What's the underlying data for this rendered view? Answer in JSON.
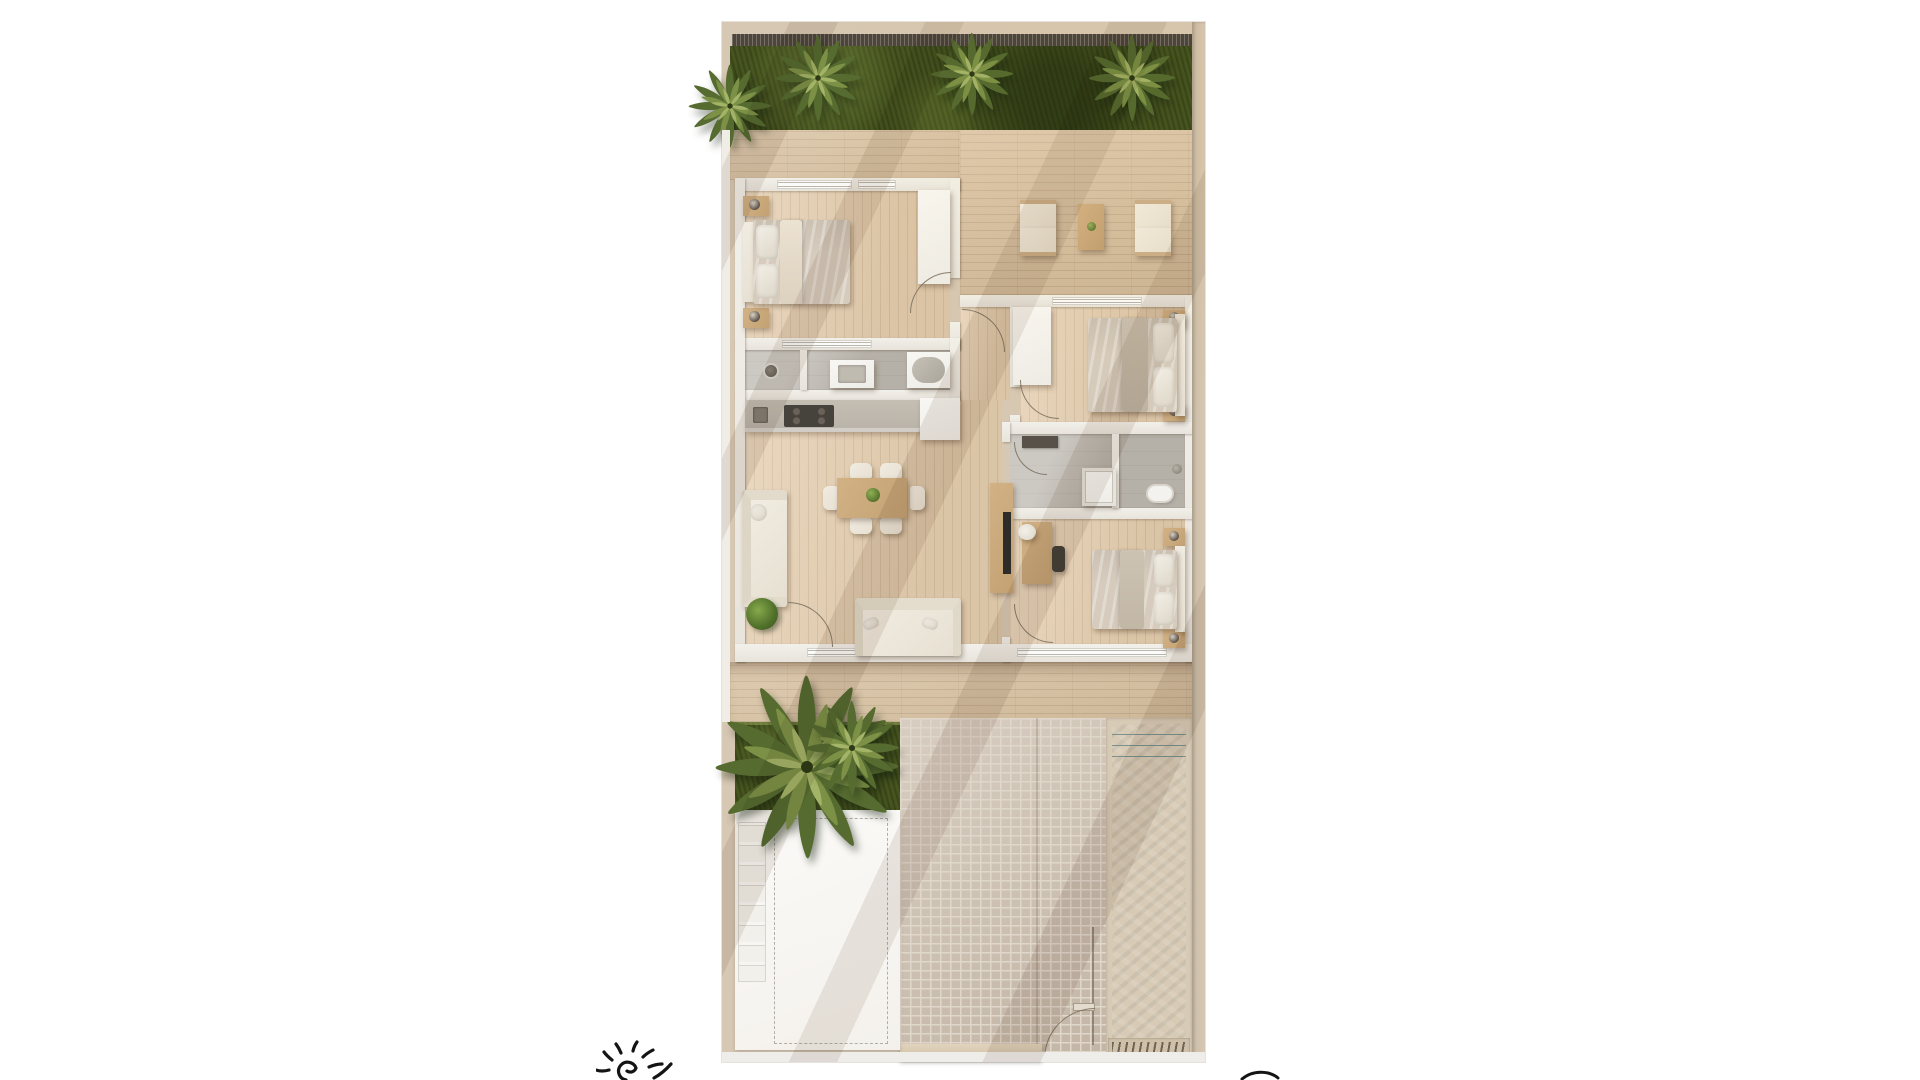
{
  "scene": {
    "type": "rendered-floor-plan",
    "view": "top-down",
    "description": "Photoreal top-down floor plan of a 3-bedroom villa with rear palm garden, wrap deck, pool, brick path and parking pad",
    "visible_text": []
  },
  "plan": {
    "garden": {
      "label": "rear garden",
      "palm_count": 4,
      "boundary": "dark slatted fence"
    },
    "rooms": [
      {
        "name": "bedroom-1",
        "label": "Bedroom 1",
        "furniture": [
          "double bed",
          "2 nightstands with lamps",
          "wardrobe"
        ]
      },
      {
        "name": "outdoor-lounge",
        "label": "Deck lounge",
        "furniture": [
          "4 armchairs",
          "coffee table with plant"
        ]
      },
      {
        "name": "bathroom-1",
        "label": "Bathroom 1",
        "furniture": [
          "walk-in shower",
          "vanity basin",
          "bathtub"
        ]
      },
      {
        "name": "kitchen",
        "label": "Kitchen",
        "furniture": [
          "counter with sink and cooktop",
          "fridge"
        ]
      },
      {
        "name": "living-dining",
        "label": "Living / Dining",
        "furniture": [
          "dining table with 6 chairs",
          "2 sofas",
          "TV sideboard",
          "potted plant"
        ]
      },
      {
        "name": "bedroom-2",
        "label": "Bedroom 2",
        "furniture": [
          "double bed",
          "2 nightstands with lamps",
          "wardrobe"
        ]
      },
      {
        "name": "bathroom-2",
        "label": "Bathroom 2",
        "furniture": [
          "shower tray",
          "toilet",
          "storage shelf"
        ]
      },
      {
        "name": "bedroom-3",
        "label": "Bedroom 3",
        "furniture": [
          "double bed",
          "2 nightstands with lamps",
          "desk with 2 chairs"
        ]
      }
    ],
    "outdoor_front": [
      {
        "name": "lower-deck",
        "label": "timber deck"
      },
      {
        "name": "lawn",
        "label": "front lawn with large palm"
      },
      {
        "name": "parking-pad",
        "label": "white parking pad with dashed marking and stepping tiles"
      },
      {
        "name": "brick-path",
        "label": "brick paved courtyard with garden gate"
      },
      {
        "name": "pool",
        "label": "plunge pool with entry steps and drain grate"
      }
    ]
  },
  "annotations": [
    {
      "name": "sun-sketch-icon",
      "description": "hand-drawn black sun doodle, cropped by bottom edge"
    },
    {
      "name": "pen-stroke",
      "description": "small black ink stroke, cropped at bottom-right"
    }
  ],
  "colors": {
    "canvas": "#ffffff",
    "frame": "#d7c8b3",
    "wall": "#e8e4dc",
    "fence": "#4e463c",
    "grass": "#46541f",
    "palmdark": "#566b30",
    "palmmid": "#7c9146",
    "palmlight": "#a3b468",
    "deck": "#d8c1a0",
    "floor": "#e4cdae",
    "bath": "#b6b1a8",
    "counter": "#b9b2a8",
    "furnwood": "#c3a173",
    "cream": "#e7e0d2",
    "duvet": "#d6cbbc",
    "tv": "#2e2c29",
    "brick": "#cfc2b3",
    "mortar": "#e0d7cb",
    "pool": "#8ba19f",
    "coping": "#d8cbb6",
    "pad": "#f4f1ec",
    "ink": "#141414",
    "shadow": "rgba(110,80,55,0.12)"
  }
}
